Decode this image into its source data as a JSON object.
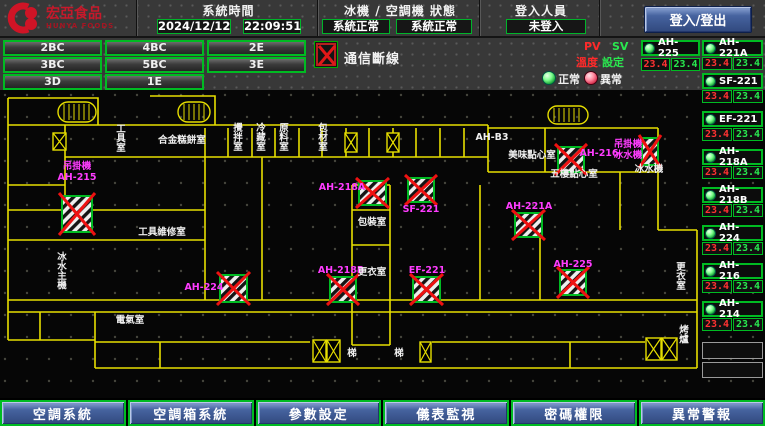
{
  "brand": {
    "name": "宏亞食品",
    "name_en": "HUNYA FOODS"
  },
  "header": {
    "time_label": "系統時間",
    "date": "2024/12/12",
    "time": "22:09:51",
    "status_label": "冰機 / 空調機 狀態",
    "chiller_status": "系統正常",
    "ahu_status": "系統正常",
    "login_label": "登入人員",
    "login_value": "未登入",
    "login_button": "登入/登出"
  },
  "floor_buttons": [
    "2BC",
    "4BC",
    "2E",
    "3BC",
    "5BC",
    "3E",
    "3D",
    "1E"
  ],
  "legend": {
    "comm_loss": "通信斷線",
    "pv": "PV",
    "sv": "SV",
    "pv_name": "溫度",
    "sv_name": "設定",
    "normal": "正常",
    "abnormal": "異常"
  },
  "equipment": {
    "featured": {
      "name": "AH-225",
      "pv": "23.4",
      "sv": "23.4",
      "status": "normal"
    },
    "list": [
      {
        "name": "AH-221A",
        "pv": "23.4",
        "sv": "23.4",
        "status": "normal"
      },
      {
        "name": "SF-221",
        "pv": "23.4",
        "sv": "23.4",
        "status": "normal"
      },
      {
        "name": "EF-221",
        "pv": "23.4",
        "sv": "23.4",
        "status": "normal"
      },
      {
        "name": "AH-218A",
        "pv": "23.4",
        "sv": "23.4",
        "status": "normal"
      },
      {
        "name": "AH-218B",
        "pv": "23.4",
        "sv": "23.4",
        "status": "normal"
      },
      {
        "name": "AH-224",
        "pv": "23.4",
        "sv": "23.4",
        "status": "normal"
      },
      {
        "name": "AH-216",
        "pv": "23.4",
        "sv": "23.4",
        "status": "normal"
      },
      {
        "name": "AH-214",
        "pv": "23.4",
        "sv": "23.4",
        "status": "normal"
      }
    ],
    "empty_slots": 2
  },
  "floorplan": {
    "comm_markers": [
      {
        "x": 62,
        "y": 106,
        "w": 30,
        "h": 36
      },
      {
        "x": 220,
        "y": 185,
        "w": 27,
        "h": 27
      },
      {
        "x": 359,
        "y": 91,
        "w": 27,
        "h": 24
      },
      {
        "x": 408,
        "y": 88,
        "w": 26,
        "h": 24
      },
      {
        "x": 330,
        "y": 187,
        "w": 26,
        "h": 25
      },
      {
        "x": 413,
        "y": 187,
        "w": 27,
        "h": 25
      },
      {
        "x": 515,
        "y": 123,
        "w": 27,
        "h": 24
      },
      {
        "x": 558,
        "y": 57,
        "w": 26,
        "h": 25
      },
      {
        "x": 642,
        "y": 48,
        "w": 16,
        "h": 27
      },
      {
        "x": 560,
        "y": 180,
        "w": 26,
        "h": 25
      }
    ],
    "shafts": [
      {
        "x": 53,
        "y": 43,
        "w": 13,
        "h": 17
      },
      {
        "x": 345,
        "y": 43,
        "w": 12,
        "h": 19
      },
      {
        "x": 387,
        "y": 43,
        "w": 12,
        "h": 19
      },
      {
        "x": 313,
        "y": 250,
        "w": 13,
        "h": 22
      },
      {
        "x": 327,
        "y": 250,
        "w": 13,
        "h": 22
      },
      {
        "x": 420,
        "y": 252,
        "w": 11,
        "h": 20
      },
      {
        "x": 646,
        "y": 248,
        "w": 15,
        "h": 22
      },
      {
        "x": 662,
        "y": 248,
        "w": 15,
        "h": 22
      }
    ],
    "stairs": [
      {
        "x": 58,
        "y": 12,
        "w": 38,
        "h": 20
      },
      {
        "x": 178,
        "y": 12,
        "w": 32,
        "h": 20
      },
      {
        "x": 548,
        "y": 16,
        "w": 40,
        "h": 18
      }
    ],
    "labels": [
      {
        "text": "吊掛機",
        "x": 77,
        "y": 79,
        "color": "magenta"
      },
      {
        "text": "AH-215",
        "x": 77,
        "y": 90,
        "color": "magenta"
      },
      {
        "text": "AH-224",
        "x": 204,
        "y": 200,
        "color": "magenta"
      },
      {
        "text": "AH-218A",
        "x": 342,
        "y": 100,
        "color": "magenta"
      },
      {
        "text": "SF-221",
        "x": 421,
        "y": 122,
        "color": "magenta"
      },
      {
        "text": "AH-218B",
        "x": 341,
        "y": 183,
        "color": "magenta"
      },
      {
        "text": "EF-221",
        "x": 427,
        "y": 183,
        "color": "magenta"
      },
      {
        "text": "AH-221A",
        "x": 529,
        "y": 119,
        "color": "magenta"
      },
      {
        "text": "AH-216",
        "x": 599,
        "y": 66,
        "color": "magenta"
      },
      {
        "text": "AH-225",
        "x": 573,
        "y": 177,
        "color": "magenta"
      },
      {
        "text": "吊掛機",
        "x": 628,
        "y": 57,
        "color": "magenta"
      },
      {
        "text": "冰水機",
        "x": 628,
        "y": 68,
        "color": "magenta"
      },
      {
        "text": "工具室",
        "x": 121,
        "y": 42,
        "color": "white",
        "vertical": true
      },
      {
        "text": "合金糕餅室",
        "x": 182,
        "y": 53,
        "color": "white"
      },
      {
        "text": "攪拌室",
        "x": 238,
        "y": 41,
        "color": "white",
        "vertical": true
      },
      {
        "text": "冷藏室",
        "x": 261,
        "y": 41,
        "color": "white",
        "vertical": true
      },
      {
        "text": "原料室",
        "x": 284,
        "y": 41,
        "color": "white",
        "vertical": true
      },
      {
        "text": "包材室",
        "x": 323,
        "y": 41,
        "color": "white",
        "vertical": true
      },
      {
        "text": "AH-B3",
        "x": 492,
        "y": 50,
        "color": "white"
      },
      {
        "text": "美味點心室",
        "x": 532,
        "y": 68,
        "color": "white"
      },
      {
        "text": "五樓點心室",
        "x": 574,
        "y": 87,
        "color": "white"
      },
      {
        "text": "冰水機",
        "x": 649,
        "y": 82,
        "color": "white"
      },
      {
        "text": "包裝室",
        "x": 372,
        "y": 135,
        "color": "white"
      },
      {
        "text": "更衣室",
        "x": 372,
        "y": 185,
        "color": "white"
      },
      {
        "text": "工具維修室",
        "x": 162,
        "y": 145,
        "color": "white"
      },
      {
        "text": "電氣室",
        "x": 130,
        "y": 233,
        "color": "white"
      },
      {
        "text": "冰水主機",
        "x": 62,
        "y": 170,
        "color": "white",
        "vertical": true
      },
      {
        "text": "梯",
        "x": 352,
        "y": 266,
        "color": "white"
      },
      {
        "text": "梯",
        "x": 399,
        "y": 266,
        "color": "white"
      },
      {
        "text": "更衣室",
        "x": 681,
        "y": 180,
        "color": "white",
        "vertical": true
      },
      {
        "text": "烤爐",
        "x": 684,
        "y": 243,
        "color": "white",
        "vertical": true
      }
    ]
  },
  "nav": [
    "空調系統",
    "空調箱系統",
    "參數設定",
    "儀表監視",
    "密碼權限",
    "異常警報"
  ],
  "colors": {
    "accent_green": "#00bb22",
    "alarm_red": "#ee1111",
    "magenta": "#ff3cff",
    "wall_yellow": "#e6de00",
    "nav_blue": "#46639f",
    "pv_red": "#ff3232",
    "sv_green": "#29e84f"
  }
}
